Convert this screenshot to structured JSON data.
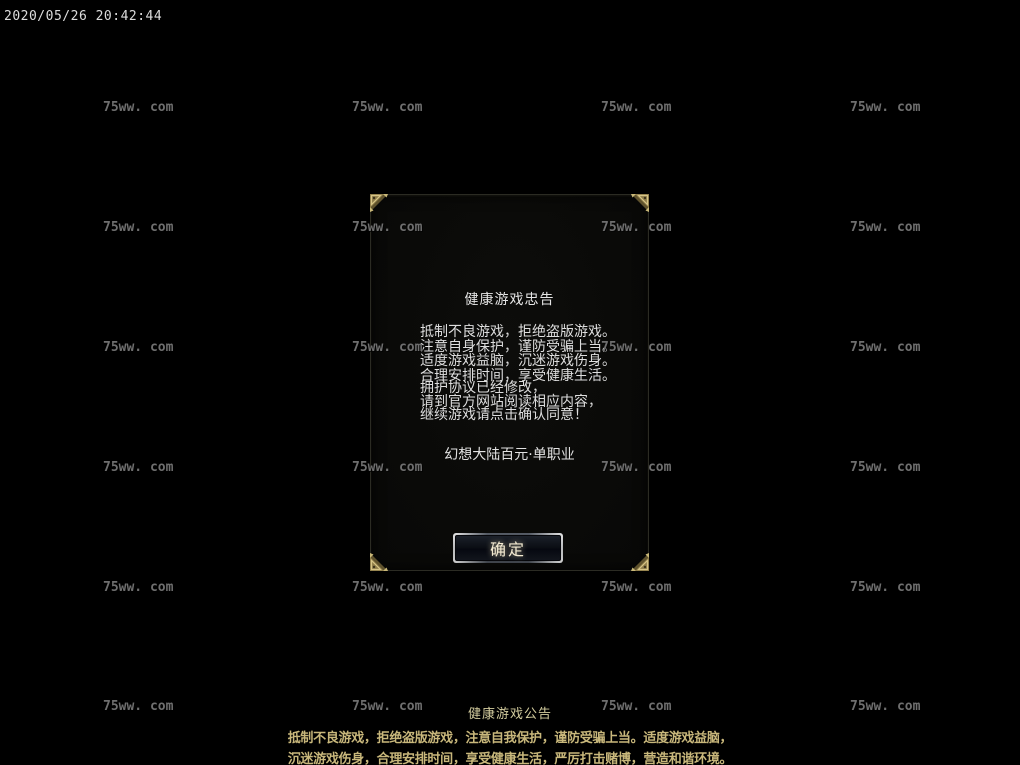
{
  "timestamp": "2020/05/26 20:42:44",
  "watermark": {
    "text": "75ww. com",
    "color": "#6f6f6f"
  },
  "dialog": {
    "title": "健康游戏忠告",
    "advisory_lines": [
      "抵制不良游戏，拒绝盗版游戏。",
      "注意自身保护，谨防受骗上当。",
      "适度游戏益脑，沉迷游戏伤身。",
      "合理安排时间，享受健康生活。"
    ],
    "notice_lines": [
      "拥护协议已经修改，",
      "请到官方网站阅读相应内容，",
      "继续游戏请点击确认同意！"
    ],
    "server_name": "幻想大陆百元·单职业",
    "confirm_label": "确定"
  },
  "announcement": {
    "title": "健康游戏公告",
    "lines": [
      "抵制不良游戏，拒绝盗版游戏，注意自我保护，谨防受骗上当。适度游戏益脑，",
      "沉迷游戏伤身，合理安排时间，享受健康生活，严厉打击赌博，营造和谐环境。"
    ]
  },
  "colors": {
    "background": "#000000",
    "watermark": "#6f6f6f",
    "dialog_text": "#dedede",
    "announcement_text": "#c8b77b",
    "ornament_gold": "#8e7c49"
  }
}
